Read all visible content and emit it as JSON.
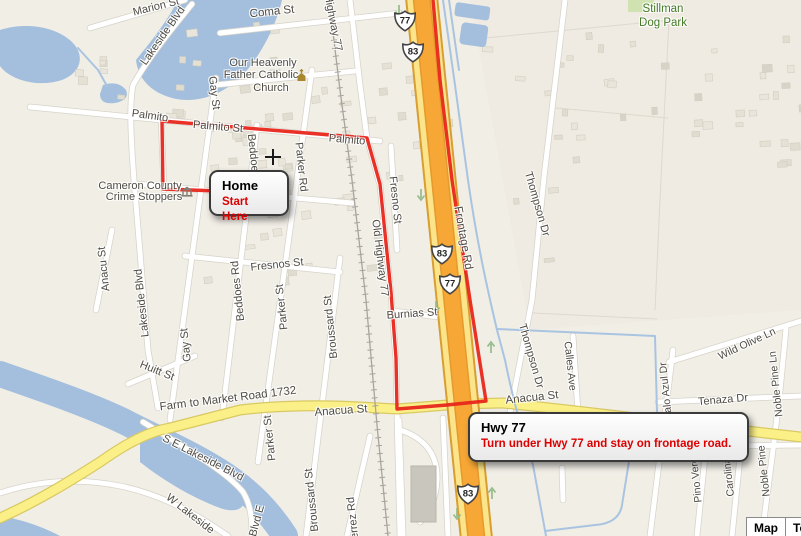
{
  "app": {
    "description": "Road map with driving route from Home to Hwy 77 frontage road"
  },
  "colors": {
    "land": "#f1eee6",
    "water": "#a3bfdd",
    "park": "#cfe2b0",
    "road_fill": "#ffffff",
    "road_casing": "#d7d3c9",
    "yellow_fill": "#fbf087",
    "yellow_casing": "#d9c964",
    "hwy_core": "#f7a735",
    "hwy_core_edge": "#e59a2d",
    "hwy_flank": "#fbe489",
    "hwy_casing": "#d89e33",
    "rail": "#a9a59c",
    "channel": "#a9c4e1",
    "route": "#e8261b",
    "label": "#4f4b44",
    "label_green": "#447a28",
    "label_gray": "#9d9a91"
  },
  "labels": [
    {
      "t": "Marion St",
      "x": 156,
      "y": 7,
      "r": -14
    },
    {
      "t": "Lakeside Blvd",
      "x": 163,
      "y": 36,
      "r": -55
    },
    {
      "t": "Coma St",
      "x": 272,
      "y": 12,
      "r": -6,
      "s": 11.5
    },
    {
      "t": "Highway 77",
      "x": 333,
      "y": 23,
      "r": 79
    },
    {
      "t": "Our Heavenly",
      "x": 263,
      "y": 63
    },
    {
      "t": "Father Catholic",
      "x": 261,
      "y": 75
    },
    {
      "t": "Church",
      "x": 271,
      "y": 88
    },
    {
      "t": "Stillman",
      "x": 663,
      "y": 9,
      "c": "green",
      "s": 11.5
    },
    {
      "t": "Dog Park",
      "x": 663,
      "y": 23,
      "c": "green",
      "s": 11.5
    },
    {
      "t": "Gay St",
      "x": 214,
      "y": 93,
      "r": 83
    },
    {
      "t": "Palmito",
      "x": 150,
      "y": 116,
      "r": 8
    },
    {
      "t": "Palmito St",
      "x": 218,
      "y": 127,
      "r": 5
    },
    {
      "t": "Palmito",
      "x": 347,
      "y": 140,
      "r": 5
    },
    {
      "t": "Beddoes Rd",
      "x": 254,
      "y": 164,
      "r": 84
    },
    {
      "t": "Parker Rd",
      "x": 301,
      "y": 167,
      "r": 84
    },
    {
      "t": "Cameron County",
      "x": 140,
      "y": 186
    },
    {
      "t": "Crime Stoppers",
      "x": 144,
      "y": 197
    },
    {
      "t": "Fresno St",
      "x": 395,
      "y": 200,
      "r": 84
    },
    {
      "t": "Thompson Dr",
      "x": 537,
      "y": 204,
      "r": 74
    },
    {
      "t": "Frontage Rd",
      "x": 463,
      "y": 238,
      "r": 80,
      "s": 11.5
    },
    {
      "t": "Old Highway 77",
      "x": 380,
      "y": 258,
      "r": 83
    },
    {
      "t": "Anacu St",
      "x": 104,
      "y": 269,
      "r": -96
    },
    {
      "t": "Fresnos St",
      "x": 277,
      "y": 265,
      "r": -6
    },
    {
      "t": "Beddoes Rd",
      "x": 238,
      "y": 291,
      "r": -96
    },
    {
      "t": "Lakeside Blvd",
      "x": 142,
      "y": 303,
      "r": -96
    },
    {
      "t": "Parker St",
      "x": 282,
      "y": 307,
      "r": -96
    },
    {
      "t": "Burnias St",
      "x": 412,
      "y": 314,
      "r": -4
    },
    {
      "t": "Broussard St",
      "x": 331,
      "y": 327,
      "r": -96
    },
    {
      "t": "Gay St",
      "x": 186,
      "y": 345,
      "r": -96
    },
    {
      "t": "Thompson Dr",
      "x": 531,
      "y": 356,
      "r": 74
    },
    {
      "t": "Wild Olive Ln",
      "x": 747,
      "y": 344,
      "r": -25,
      "s": 10.5
    },
    {
      "t": "Calles Ave",
      "x": 570,
      "y": 366,
      "r": 84,
      "s": 10.5
    },
    {
      "t": "Huitt St",
      "x": 157,
      "y": 371,
      "r": 22
    },
    {
      "t": "Noble Pine Ln",
      "x": 776,
      "y": 384,
      "r": -96,
      "s": 10.5
    },
    {
      "t": "Palo Azul Dr",
      "x": 666,
      "y": 391,
      "r": -96,
      "s": 10.5
    },
    {
      "t": "Farm to Market Road 1732",
      "x": 228,
      "y": 399,
      "r": -7,
      "s": 11.5
    },
    {
      "t": "Tenaza Dr",
      "x": 723,
      "y": 400,
      "r": -5
    },
    {
      "t": "Anacua St",
      "x": 341,
      "y": 411,
      "r": -4,
      "s": 11.5
    },
    {
      "t": "Anacua St",
      "x": 532,
      "y": 398,
      "r": -6,
      "s": 11.5
    },
    {
      "t": "Naranjo Rd",
      "x": 716,
      "y": 427,
      "r": -3,
      "c": "gray"
    },
    {
      "t": "Parker St",
      "x": 270,
      "y": 438,
      "r": -96
    },
    {
      "t": "S E Lakeside Blvd",
      "x": 203,
      "y": 458,
      "r": 27
    },
    {
      "t": "Noble Pine",
      "x": 764,
      "y": 471,
      "r": -96,
      "s": 10.5
    },
    {
      "t": "Pino Verde",
      "x": 696,
      "y": 477,
      "r": -96,
      "s": 10.5
    },
    {
      "t": "Carolina",
      "x": 729,
      "y": 477,
      "r": -96,
      "s": 10.5
    },
    {
      "t": "Broussard St",
      "x": 312,
      "y": 500,
      "r": -96
    },
    {
      "t": "Blvd E",
      "x": 257,
      "y": 521,
      "r": -75
    },
    {
      "t": "W Lakeside",
      "x": 190,
      "y": 514,
      "r": 38
    },
    {
      "t": "Gutierrez Rd",
      "x": 354,
      "y": 528,
      "r": -96
    }
  ],
  "callouts": {
    "home": {
      "title": "Home",
      "subtitle": "Start Here"
    },
    "hwy77": {
      "title": "Hwy 77",
      "subtitle": "Turn under Hwy 77 and stay on frontage road."
    }
  },
  "shields": [
    {
      "n": "77",
      "x": 405,
      "y": 21
    },
    {
      "n": "83",
      "x": 413,
      "y": 52
    },
    {
      "n": "83",
      "x": 442,
      "y": 254
    },
    {
      "n": "77",
      "x": 450,
      "y": 284
    },
    {
      "n": "83",
      "x": 468,
      "y": 494
    }
  ],
  "arrows": [
    {
      "x": 399,
      "y": 4,
      "d": "down"
    },
    {
      "x": 421,
      "y": 188,
      "d": "down"
    },
    {
      "x": 436,
      "y": 300,
      "d": "down"
    },
    {
      "x": 457,
      "y": 507,
      "d": "down"
    },
    {
      "x": 491,
      "y": 341,
      "d": "up"
    },
    {
      "x": 492,
      "y": 487,
      "d": "up"
    }
  ],
  "icons": [
    {
      "type": "church-icon",
      "x": 295,
      "y": 69
    },
    {
      "type": "cross-icon",
      "x": 265,
      "y": 149
    },
    {
      "type": "institution-icon",
      "x": 181,
      "y": 186
    }
  ],
  "controls": {
    "map": "Map",
    "terrain": "Te"
  }
}
